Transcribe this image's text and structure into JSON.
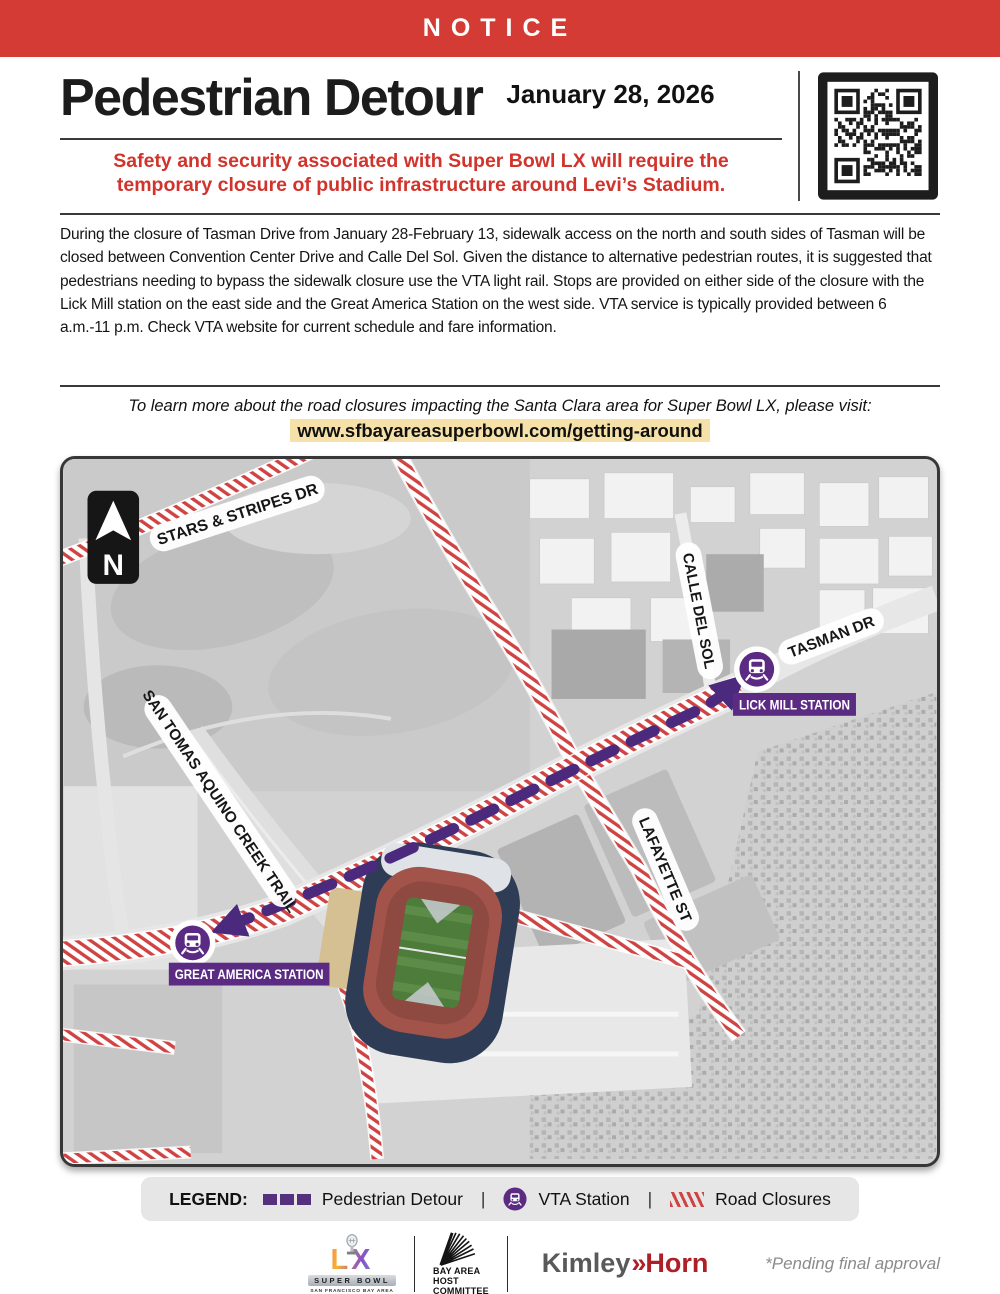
{
  "notice": {
    "label": "NOTICE"
  },
  "header": {
    "title": "Pedestrian Detour",
    "date": "January 28, 2026",
    "subtitle": "Safety and security associated with Super Bowl LX will require the temporary closure of public infrastructure around Levi’s Stadium."
  },
  "body": {
    "paragraph": "During the closure of Tasman Drive from January 28-February 13, sidewalk access on the north and south sides of Tasman will be closed between Convention Center Drive and Calle Del Sol. Given the distance to alternative pedestrian routes, it is suggested that pedestrians needing to bypass the sidewalk closure use the VTA light rail. Stops are provided on either side of the closure with the Lick Mill station on the east side and the Great America Station on the west side. VTA service is typically provided between 6 a.m.-11 p.m. Check VTA website for current schedule and fare information."
  },
  "link": {
    "intro": "To learn more about the road closures impacting the Santa Clara area for Super Bowl LX, please visit:",
    "url": "www.sfbayareasuperbowl.com/getting-around"
  },
  "map": {
    "north_label": "N",
    "streets": {
      "stars_stripes": "STARS & STRIPES DR",
      "calle_del_sol": "CALLE DEL SOL",
      "tasman": "TASMAN DR",
      "san_tomas": "SAN TOMAS AQUINO CREEK TRAIL",
      "lafayette": "LAFAYETTE ST"
    },
    "stations": {
      "lick_mill": "LICK MILL STATION",
      "great_america": "GREAT AMERICA STATION"
    }
  },
  "legend": {
    "label": "LEGEND:",
    "pedestrian_detour": "Pedestrian Detour",
    "vta_station": "VTA Station",
    "road_closures": "Road Closures",
    "divider": "|"
  },
  "footer": {
    "superbowl": {
      "letters": "LX",
      "name": "SUPER BOWL",
      "sub": "SAN FRANCISCO BAY AREA"
    },
    "host_committee": {
      "line1": "BAY AREA",
      "line2": "HOST",
      "line3": "COMMITTEE"
    },
    "kimley": {
      "part1": "Kimley",
      "chevrons": "»",
      "part2": "Horn"
    },
    "pending": "*Pending final approval"
  },
  "colors": {
    "accent_red": "#d43b35",
    "subtitle_red": "#d0342c",
    "closure_hatch_red": "#cf4343",
    "detour_purple": "#4b2a7d",
    "station_purple": "#5b2b84",
    "link_highlight": "#f6e2a9"
  }
}
